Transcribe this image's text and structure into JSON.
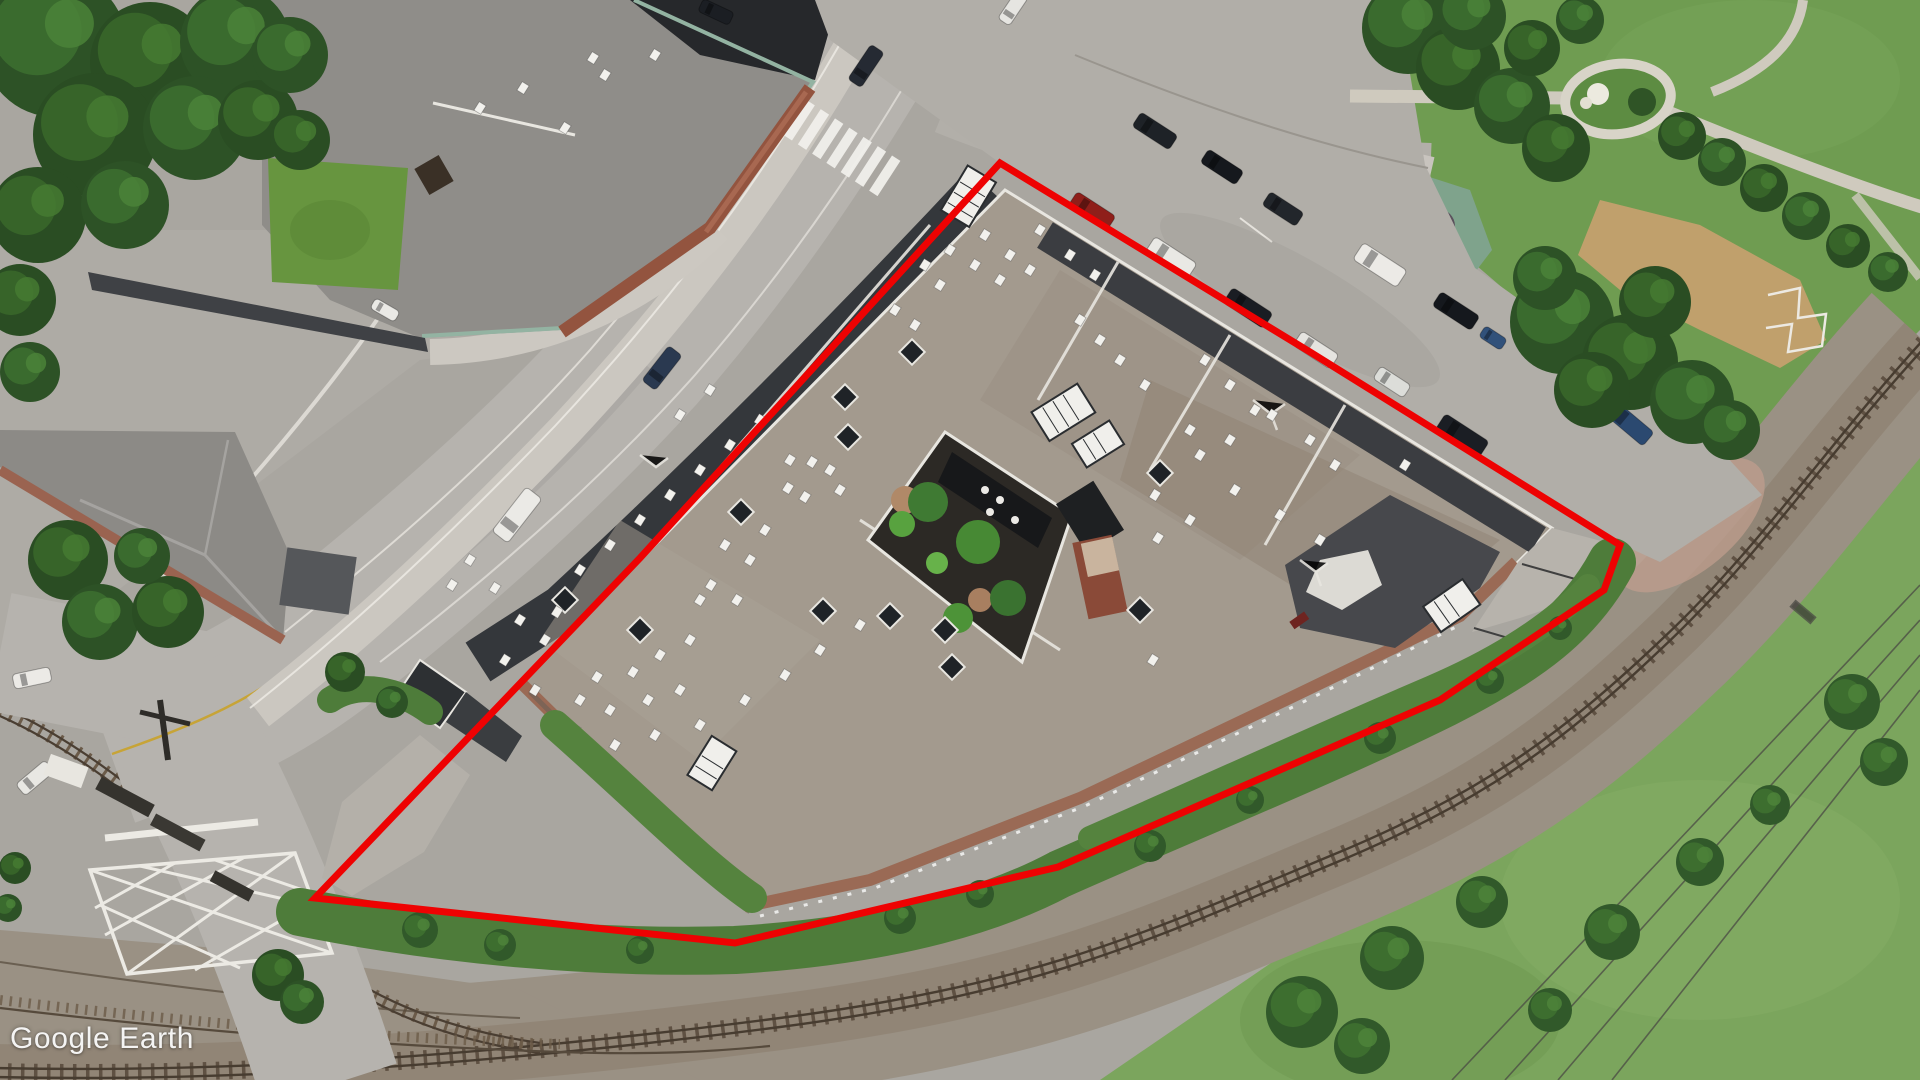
{
  "watermark": {
    "text": "Google Earth"
  },
  "property_outline": {
    "color": "#ee0202",
    "stroke_width": "7",
    "points": "1000,163 1310,352 1620,545 1604,590 1440,700 1058,867 735,943 315,898 640,558"
  }
}
